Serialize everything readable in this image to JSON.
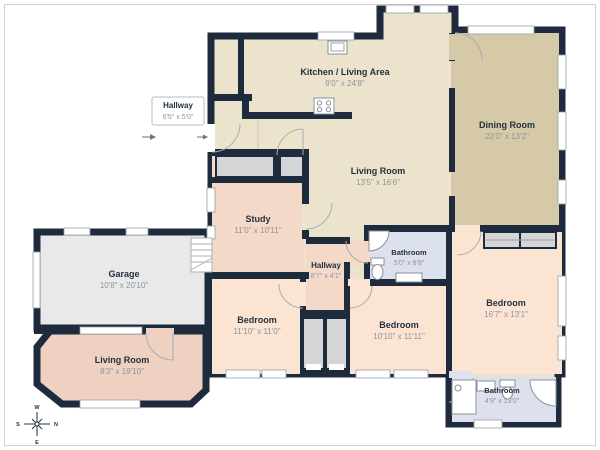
{
  "plan_title": "Floor plan",
  "rooms": [
    {
      "id": "kitchen-living-area",
      "name": "Kitchen / Living Area",
      "dims": "9'0\" x 24'8\""
    },
    {
      "id": "living-room-main",
      "name": "Living Room",
      "dims": "13'5\" x 16'6\""
    },
    {
      "id": "dining-room",
      "name": "Dining Room",
      "dims": "22'0\" x 13'2\""
    },
    {
      "id": "study",
      "name": "Study",
      "dims": "11'0\" x 10'11\""
    },
    {
      "id": "hallway-center",
      "name": "Hallway",
      "dims": "8'7\" x 4'1\""
    },
    {
      "id": "bathroom-center",
      "name": "Bathroom",
      "dims": "5'0\" x 8'8\""
    },
    {
      "id": "bedroom-left",
      "name": "Bedroom",
      "dims": "11'10\" x 11'0\""
    },
    {
      "id": "bedroom-center",
      "name": "Bedroom",
      "dims": "10'10\" x 11'11\""
    },
    {
      "id": "bedroom-right",
      "name": "Bedroom",
      "dims": "16'7\" x 13'1\""
    },
    {
      "id": "bathroom-right",
      "name": "Bathroom",
      "dims": "4'9\" x 13'0\""
    },
    {
      "id": "garage",
      "name": "Garage",
      "dims": "10'8\" x 20'10\""
    },
    {
      "id": "living-room-left",
      "name": "Living Room",
      "dims": "8'3\" x 19'10\""
    }
  ],
  "callout": {
    "name": "Hallway",
    "dims": "6'5\" x 5'0\""
  },
  "compass": {
    "up": "W",
    "left": "S",
    "right": "N",
    "down": "E"
  },
  "colors": {
    "wall": "#1e2b3d",
    "open_area": "#ece3cc",
    "dining": "#d5c9a7",
    "study_hall": "#f4d9c9",
    "bedroom": "#fbe5d2",
    "annex_living": "#eed1c0",
    "garage": "#e9e9ea",
    "closet": "#d4d5d7",
    "bathroom": "#dce1ed"
  }
}
